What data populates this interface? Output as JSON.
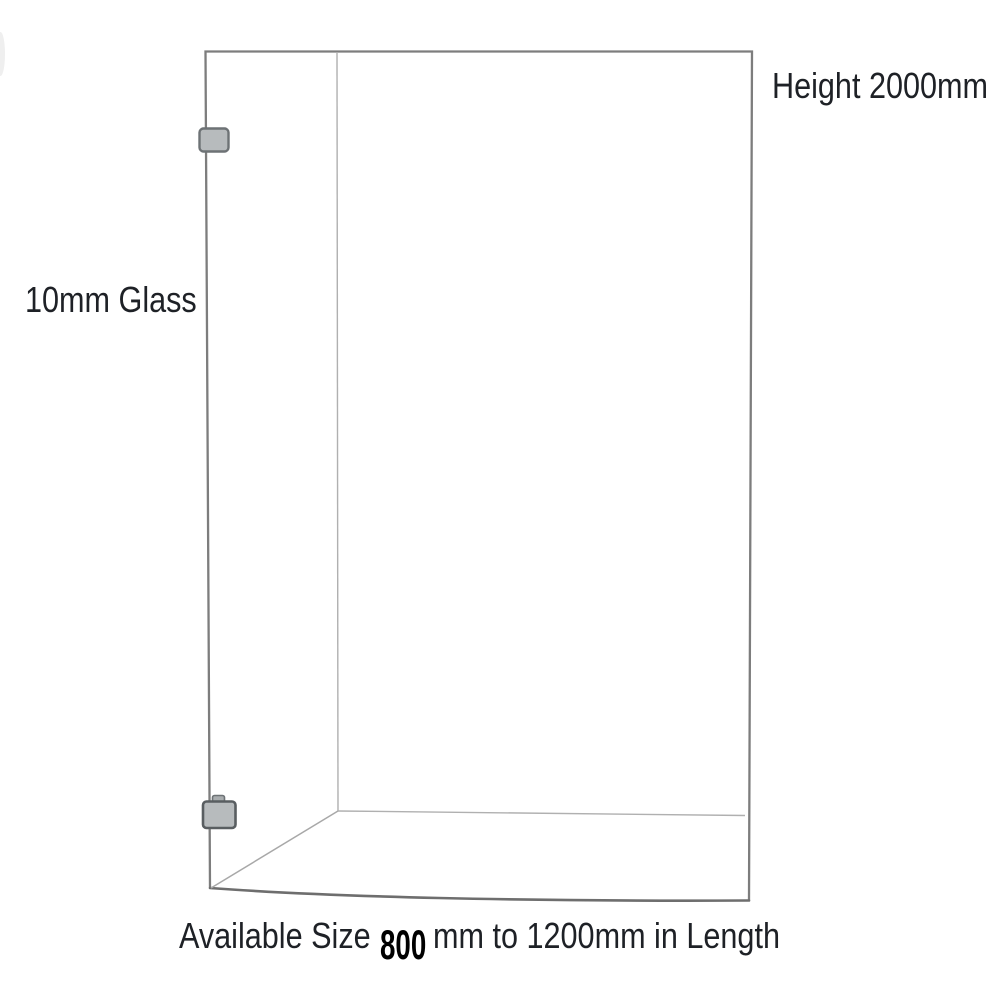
{
  "page": {
    "background": "#ffffff"
  },
  "labels": {
    "height": "Height 2000mm",
    "glass": "10mm Glass",
    "size_prefix": "Available Size",
    "size_value": "800",
    "size_suffix": "mm to 1200mm in Length"
  },
  "colors": {
    "page_bg": "#ffffff",
    "outline": "#7d7d7d",
    "outline_bottom": "#6e6e6e",
    "inner_line": "#b0b0b0",
    "diagonal_line": "#a8a8a8",
    "bracket_fill": "#b7bbbd",
    "bracket_tab_fill": "#a9adaf",
    "bracket_border": "#6d7275",
    "bracket_border_dark": "#595e61",
    "text": "#1e2126",
    "size_value_color": "#000000",
    "smudge": "#efefef"
  },
  "icons": {
    "bracket_top": "wall-mount-clamp-icon",
    "bracket_bottom": "wall-mount-clamp-icon"
  }
}
